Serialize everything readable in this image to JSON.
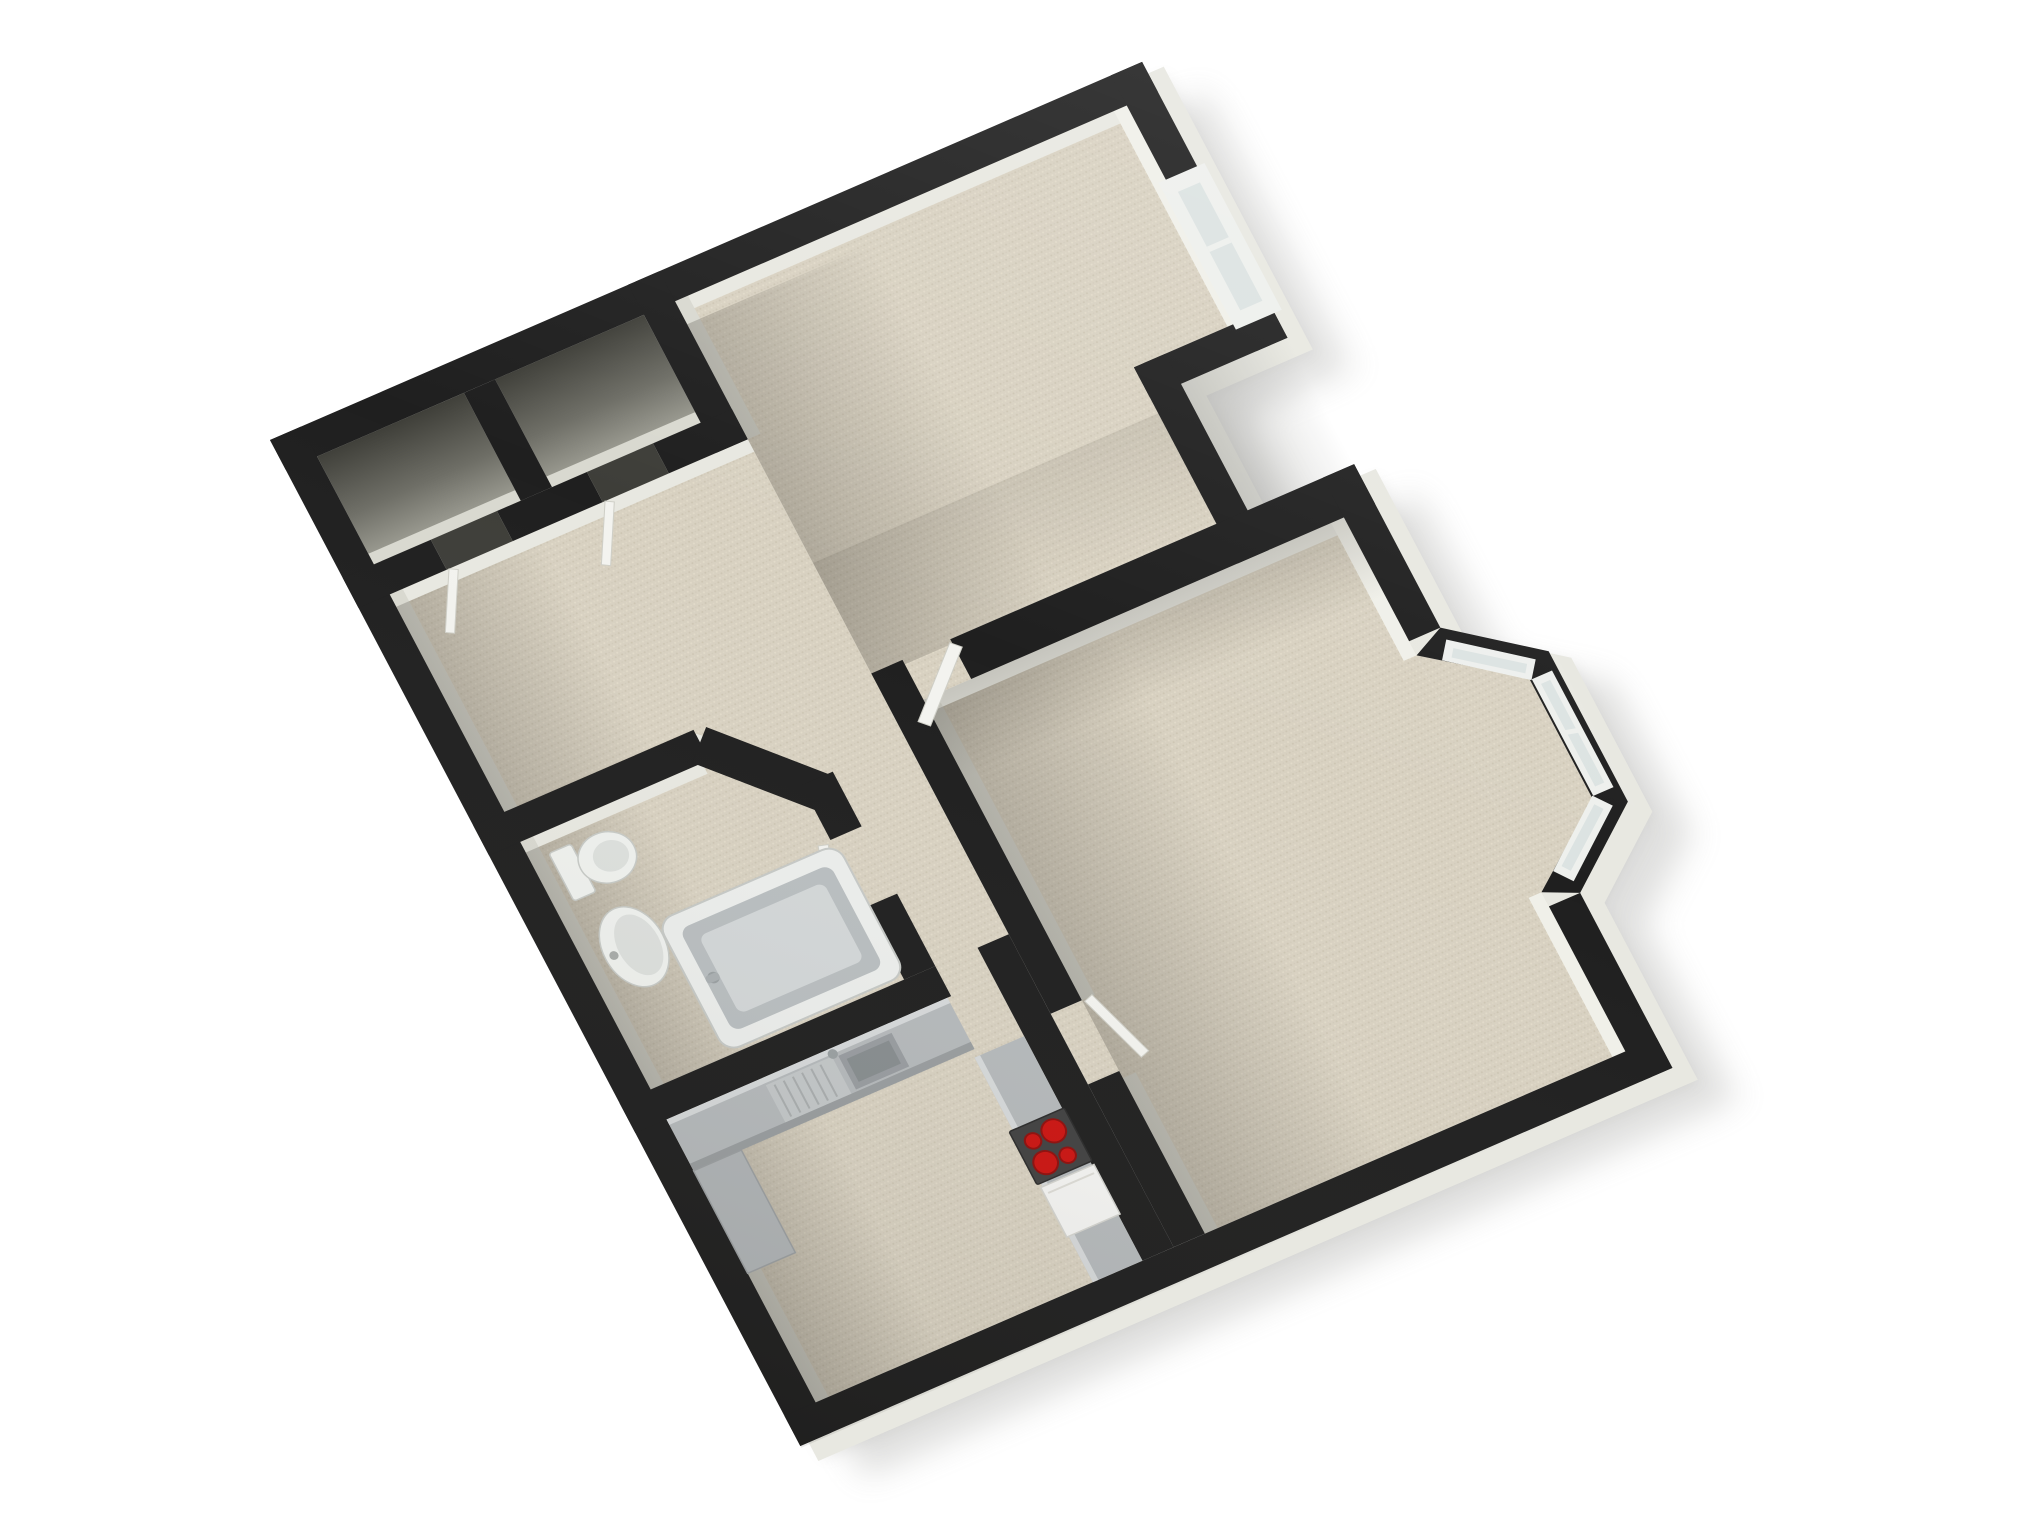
{
  "palette": {
    "bg": "#ffffff",
    "wall": "#1f1f1f",
    "wallFace": "#e8e8e1",
    "wallFacePale": "#f0f0e9",
    "wallFaceDim": "#d9d9d0",
    "carpet": "#d8d1c1",
    "carpetDotDark": "#c9c1ae",
    "carpetDotLight": "#e4ddcc",
    "closetDark": "#3f3f39",
    "closetLight": "#a2a298",
    "counter": "#b5b9bb",
    "counterDark": "#989ca0",
    "stove": "#414141",
    "burner": "#cc1411",
    "burnerRing": "#8f0e0c",
    "appliance": "#f4f4f2",
    "fixture": "#eff1ee",
    "fixtureEdge": "#c7cac6",
    "fixtureInner": "#dde0dd",
    "tubRim": "#eceeec",
    "tubInner": "#b9bec0",
    "tubBasin": "#d3d7d8",
    "glass": "#dce3e2",
    "frame": "#eef0ed",
    "door": "#f3f3ef",
    "threshold": "#3e3e39",
    "shadow": "#8e8e8a"
  },
  "floor_plan": {
    "view": "3d-birds-eye dollhouse render, rotated plan on white background",
    "rotation_deg": -25,
    "rooms": [
      {
        "name": "closet-1",
        "floor": "dark"
      },
      {
        "name": "closet-2",
        "floor": "dark"
      },
      {
        "name": "hallway",
        "floor": "carpet"
      },
      {
        "name": "living-room",
        "floor": "carpet",
        "features": [
          "window-top-right",
          "corner-notch"
        ]
      },
      {
        "name": "bedroom",
        "floor": "carpet",
        "features": [
          "bay-window-3-panes",
          "door-open"
        ]
      },
      {
        "name": "bathroom",
        "floor": "carpet",
        "fixtures": [
          "toilet",
          "pedestal-sink",
          "bathtub"
        ]
      },
      {
        "name": "kitchen",
        "floor": "carpet",
        "fixtures": [
          "counter-with-sink",
          "tall-unit",
          "hob-4-red-burners",
          "white-appliance"
        ]
      }
    ],
    "window_count": 4,
    "hob_burner_count": 4,
    "door_leaves_visible": 5
  }
}
